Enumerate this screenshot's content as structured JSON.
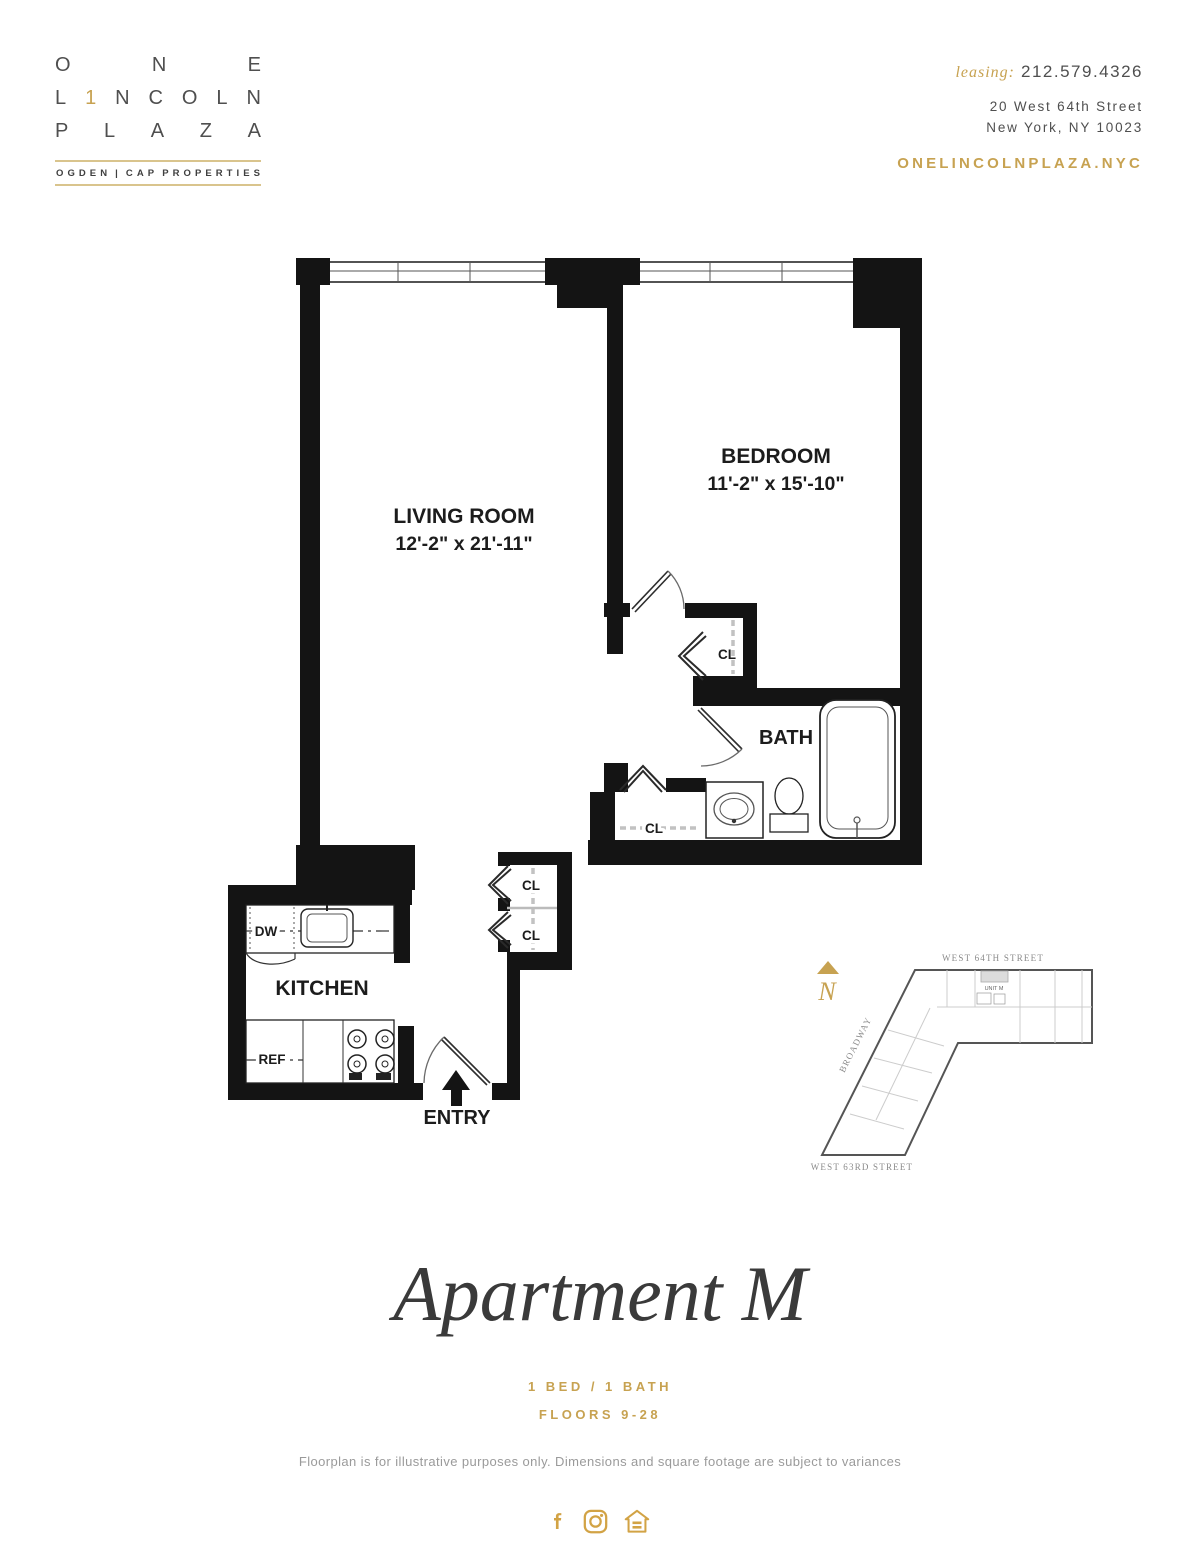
{
  "colors": {
    "gold": "#c7a251",
    "gold_light": "#d9c48d",
    "gold_icon": "#d2a345",
    "plan_ink": "#141414",
    "text_gray": "#9a9a9a"
  },
  "header": {
    "logo": {
      "line1": "ONE",
      "line2": "L1NCOLN",
      "line3": "PLAZA",
      "tagline": "OGDEN | CAP PROPERTIES"
    },
    "leasing_label": "leasing:",
    "phone": "212.579.4326",
    "address_line1": "20 West 64th Street",
    "address_line2": "New York, NY 10023",
    "website": "ONELINCOLNPLAZA.NYC"
  },
  "plan": {
    "living_room_name": "LIVING ROOM",
    "living_room_dims": "12'-2\" x 21'-11\"",
    "bedroom_name": "BEDROOM",
    "bedroom_dims": "11'-2\" x 15'-10\"",
    "bath_name": "BATH",
    "kitchen_name": "KITCHEN",
    "entry_name": "ENTRY",
    "closet_label": "CL",
    "dishwasher_label": "DW",
    "refrigerator_label": "REF"
  },
  "site_map": {
    "north_label": "N",
    "street_top": "WEST 64TH STREET",
    "street_left": "BROADWAY",
    "street_bottom": "WEST 63RD STREET",
    "unit_label": "UNIT M"
  },
  "footer": {
    "title": "Apartment M",
    "subtitle_line1": "1 BED / 1 BATH",
    "subtitle_line2": "FLOORS 9-28",
    "disclaimer": "Floorplan is for illustrative purposes only. Dimensions and square footage are subject to variances",
    "social": [
      "facebook",
      "instagram",
      "equal-housing"
    ]
  }
}
